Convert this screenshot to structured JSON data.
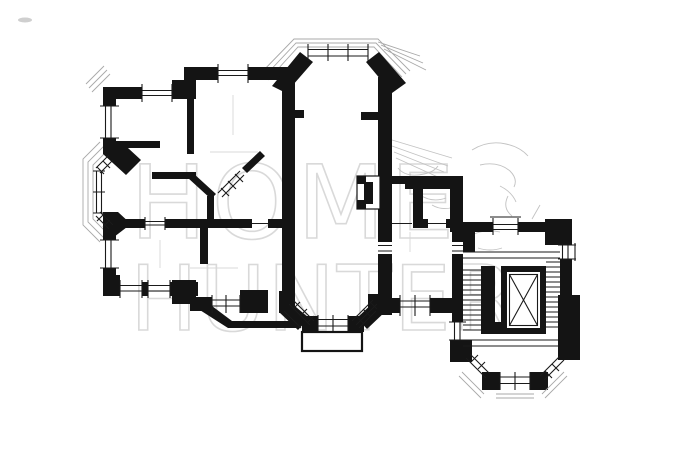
{
  "title": "Apartment floor plan drawing",
  "watermark": {
    "line1": "HOME",
    "line2": "HUNTER",
    "color": "#d9d9d9"
  },
  "colors": {
    "background": "#ffffff",
    "walls": "#141414",
    "thin_lines": "#1a1a1a",
    "eave_lines": "#a8a8a8",
    "sketch_artifacts": "#c2c2c2",
    "watermark": "#d9d9d9"
  },
  "elements": {
    "left_bay": "pentagonal-bay-window",
    "top_bow": "bow-window-tower-top",
    "bottom_bay": "bay-window-with-balcony",
    "balcony": "balcony-outline",
    "fireplace": "chimney-flue-niche",
    "staircase": "double-flight-staircase",
    "elevator": "elevator-shaft-crossed",
    "entrance_bay": "rounded-entrance-porch"
  }
}
